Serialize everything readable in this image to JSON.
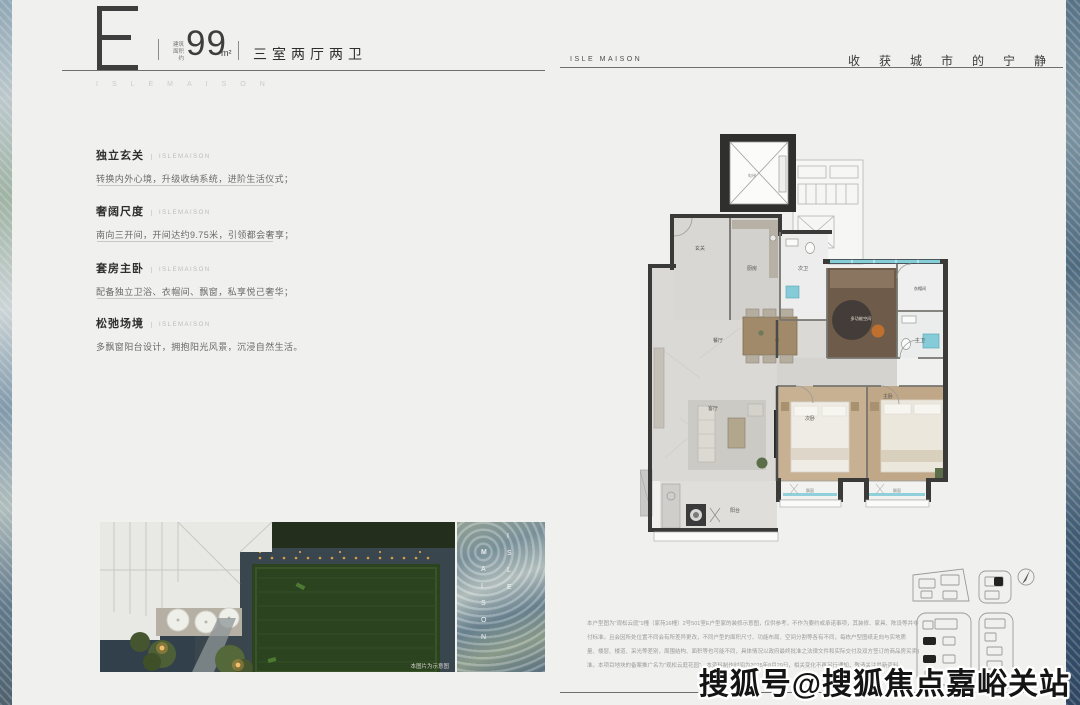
{
  "header_left": {
    "plan_letter": "E",
    "area_prefix": "建筑\n面积约",
    "area_value": "99",
    "area_unit": "m²",
    "layout_text": "三室两厅两卫",
    "brand_spaced": "ISLEMAISON"
  },
  "header_right": {
    "brand": "ISLE MAISON",
    "tagline": "收获城市的宁静"
  },
  "features": [
    {
      "title": "独立玄关",
      "brand": "ISLEMAISON",
      "desc": "转换内外心境，升级收纳系统，进阶生活仪式；"
    },
    {
      "title": "奢阔尺度",
      "brand": "ISLEMAISON",
      "desc": "南向三开间，开间达约9.75米，引领都会奢享；"
    },
    {
      "title": "套房主卧",
      "brand": "ISLEMAISON",
      "desc": "配备独立卫浴、衣帽间、飘窗，私享悦己奢华；"
    },
    {
      "title": "松弛场境",
      "brand": "ISLEMAISON",
      "desc": "多飘窗阳台设计，拥抱阳光风景，沉浸自然生活。"
    }
  ],
  "photo": {
    "caption": "本图片为示意图"
  },
  "glass_panel": {
    "col_a": "I\nS\nL\nE",
    "col_b": "M\nA\nI\nS\nO\nN"
  },
  "floorplan": {
    "rooms": {
      "entry": "玄关",
      "kitchen": "厨房",
      "bath2": "次卫",
      "dining": "餐厅",
      "living": "客厅",
      "balcony": "阳台",
      "bedroom2": "次卧",
      "master": "主卧",
      "master_bath": "主卫",
      "closet": "衣帽间",
      "multi": "多功能空间",
      "bay1": "飘窗",
      "bay2": "飘窗",
      "elevator": "电梯"
    }
  },
  "disclaimer": {
    "lines": [
      "本户型图为\"观松云庭\"1幢（家苑16幢）2号501室E户型家的装修示意图，仅供参考，不作为要约或承诺事项，其装修、家具、陈设等并非交",
      "付标准。且会因所处位置不同会有所差异更改，不同户型的面积尺寸、功能布局、空间分割等各有不同，每栋户型图纸走向与实地质",
      "量、楼层、楼道、采光等差别，周围结构、面积等也可能不同，具体情况以政府最终批准之法律文件和实际交付及双方签订的商品房买卖合同为",
      "准。本项目地块的备案推广名为\"观松云庭花园\"。本资料制作时间为2025年8月29日，相关变化不再另行通知，敬请关注最新资料。"
    ]
  },
  "watermark": "搜狐号@搜狐焦点嘉峪关站",
  "colors": {
    "accent_teal": "#85cbd8",
    "wall_dark": "#3a3a39",
    "wood": "#c0a787",
    "marble": "#dad9d6"
  }
}
